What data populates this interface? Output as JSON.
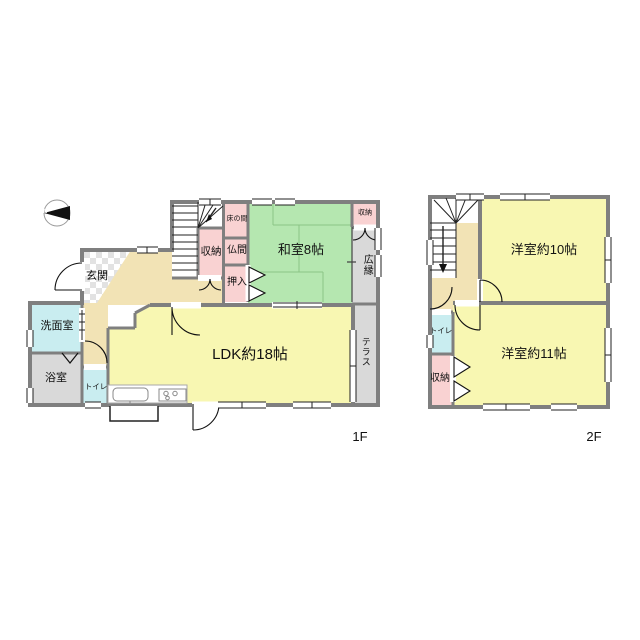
{
  "compass": {
    "north_label": "N"
  },
  "floor1": {
    "label": "1F",
    "rooms": {
      "genkan": "玄関",
      "senmenshitsu": "洗面室",
      "yokushitsu": "浴室",
      "toire": "トイレ",
      "shuno_kaidan": "収納",
      "tokonoma": "床の間",
      "butsuma": "仏間",
      "oshiire": "押入",
      "washitsu": "和室8帖",
      "shuno_hiroen": "収納",
      "hiroen": "広縁",
      "ldk": "LDK約18帖",
      "terrace": "テラス"
    }
  },
  "floor2": {
    "label": "2F",
    "rooms": {
      "yoshitsu10": "洋室約10帖",
      "yoshitsu11": "洋室約11帖",
      "toire": "トイレ",
      "shuno": "収納"
    }
  },
  "colors": {
    "wall": "#7f7f7f",
    "tatami_room": "#b5e7b0",
    "wood_room": "#f8f7b2",
    "hall": "#f2e3b5",
    "storage": "#f9d2d2",
    "wet_room": "#c9edf0",
    "gray_room": "#d9d9d9"
  }
}
